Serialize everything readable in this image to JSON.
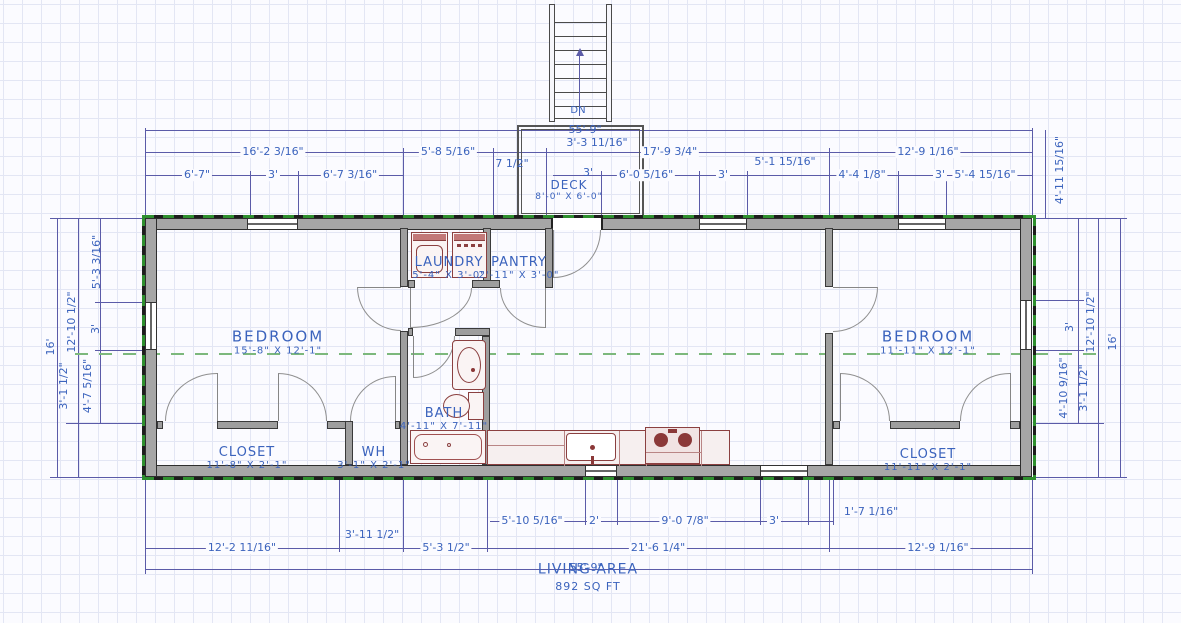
{
  "rooms": {
    "bedroom_left": {
      "name": "BEDROOM",
      "dims": "15'-8\" X 12'-1\""
    },
    "bedroom_right": {
      "name": "BEDROOM",
      "dims": "11'-11\" X 12'-1\""
    },
    "laundry": {
      "name": "LAUNDRY",
      "dims": "5'-4\" X 3'-0\""
    },
    "pantry": {
      "name": "PANTRY",
      "dims": "2'-11\" X 3'-0\""
    },
    "bath": {
      "name": "BATH",
      "dims": "4'-11\" X 7'-11\""
    },
    "closet_left": {
      "name": "CLOSET",
      "dims": "11'-8\" X 2'-1\""
    },
    "water_heater": {
      "name": "WH",
      "dims": "3'-1\" X 2'-1\""
    },
    "closet_right": {
      "name": "CLOSET",
      "dims": "11'-11\" X 2'-1\""
    },
    "deck": {
      "name": "DECK",
      "dims": "8'-0\" X 6'-0\""
    }
  },
  "living_area": {
    "line1": "LIVING AREA",
    "line2": "892 SQ FT"
  },
  "stairs": {
    "down_label": "DN"
  },
  "dims": {
    "overall_top": "55'-9\"",
    "overall_bottom": "55'-9\"",
    "top2": {
      "a": "16'-2 3/16\"",
      "b": "5'-8 5/16\"",
      "c": "3'-3 11/16\"",
      "d": "17'-9 3/4\"",
      "e": "12'-9 1/16\""
    },
    "top3": {
      "a": "6'-7\"",
      "b": "3'",
      "c": "6'-7 3/16\"",
      "d": "7 1/2\"",
      "e": "3'",
      "f": "6'-0 5/16\"",
      "g": "3'",
      "h": "5'-1 15/16\"",
      "i": "4'-4 1/8\"",
      "j": "3'",
      "k": "5'-4 15/16\""
    },
    "left": {
      "overall": "16'",
      "upper": "12'-10 1/2\"",
      "lower": "3'-1 1/2\"",
      "inner_top": "5'-3 3/16\"",
      "inner_mid": "3'",
      "inner_bot": "4'-7 5/16\""
    },
    "right": {
      "overall": "16'",
      "upper": "12'-10 1/2\"",
      "lower": "3'-1 1/2\"",
      "inner_top": "4'-11 15/16\"",
      "inner_mid": "3'",
      "inner_bot": "4'-10 9/16\""
    },
    "bottom1": {
      "a": "5'-10 5/16\"",
      "b": "2'",
      "c": "9'-0 7/8\"",
      "d": "3'",
      "e": "1'-7 1/16\""
    },
    "bottom2": {
      "a": "12'-2 11/16\"",
      "b": "3'-11 1/2\"",
      "c": "5'-3 1/2\"",
      "d": "21'-6 1/4\"",
      "e": "12'-9 1/16\""
    }
  },
  "colors": {
    "dimension_text": "#3b63bd",
    "dimension_line": "#5b5ba8",
    "wall_fill": "#a6a6a6",
    "exterior_dashed_green": "#2f8f2f",
    "centerline_green": "#7cb87c",
    "fixture_outline": "#8b4040",
    "grid": "#e3e6f4"
  }
}
